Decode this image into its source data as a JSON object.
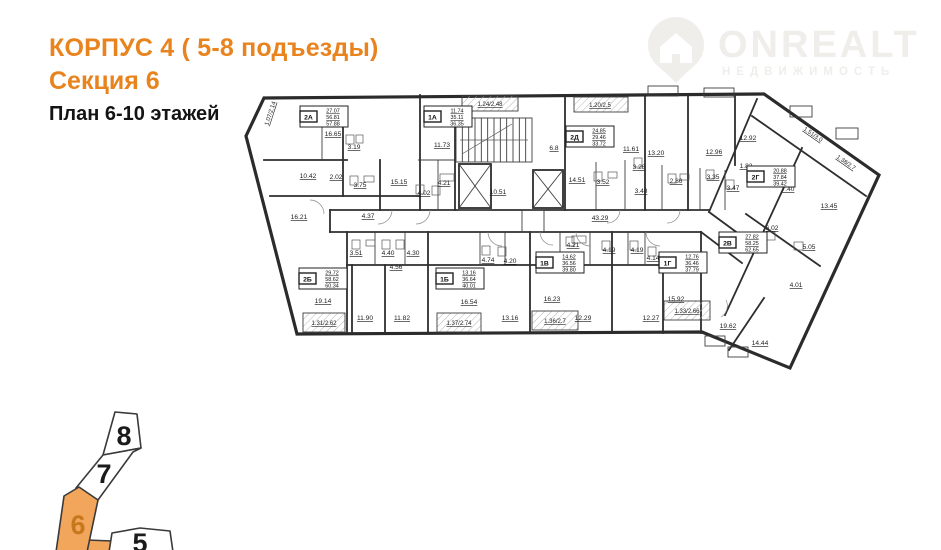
{
  "header": {
    "building": "КОРПУС 4 ( 5-8 подъезды)",
    "section": "Секция 6",
    "floors": "План 6-10 этажей"
  },
  "watermark": {
    "brand": "ONREALT",
    "tagline": "НЕДВИЖИМОСТЬ"
  },
  "colors": {
    "accent": "#e8831d",
    "plan_line": "#2e2e2e",
    "minimap_fill": "#f2a65b",
    "minimap_number": "#c8781c",
    "watermark": "#f0eeea"
  },
  "floorplan": {
    "outline": [
      [
        264,
        98
      ],
      [
        764,
        94
      ],
      [
        879,
        175
      ],
      [
        790,
        368
      ],
      [
        702,
        332
      ],
      [
        297,
        334
      ],
      [
        246,
        136
      ]
    ],
    "walls": [
      [
        420,
        95,
        420,
        210
      ],
      [
        455,
        117,
        455,
        210
      ],
      [
        565,
        95,
        565,
        210
      ],
      [
        645,
        95,
        645,
        210
      ],
      [
        688,
        95,
        688,
        210
      ],
      [
        735,
        96,
        735,
        165
      ],
      [
        757,
        99,
        709,
        212
      ],
      [
        330,
        210,
        709,
        210
      ],
      [
        330,
        232,
        701,
        232
      ],
      [
        709,
        212,
        758,
        248
      ],
      [
        701,
        232,
        742,
        263
      ],
      [
        347,
        232,
        347,
        333
      ],
      [
        428,
        232,
        428,
        333
      ],
      [
        530,
        232,
        530,
        333
      ],
      [
        612,
        232,
        612,
        333
      ],
      [
        701,
        232,
        701,
        333
      ],
      [
        347,
        265,
        701,
        265
      ],
      [
        352,
        265,
        352,
        333
      ],
      [
        385,
        265,
        385,
        333
      ],
      [
        663,
        265,
        663,
        333
      ],
      [
        264,
        160,
        347,
        160
      ],
      [
        270,
        196,
        420,
        196
      ],
      [
        343,
        120,
        343,
        196
      ],
      [
        380,
        160,
        380,
        210
      ],
      [
        330,
        210,
        330,
        232
      ],
      [
        752,
        116,
        866,
        196
      ],
      [
        802,
        148,
        725,
        315
      ],
      [
        746,
        214,
        820,
        266
      ],
      [
        764,
        298,
        729,
        350
      ]
    ],
    "partitions": [
      [
        596,
        162,
        596,
        210
      ],
      [
        625,
        160,
        625,
        210
      ],
      [
        662,
        165,
        662,
        210
      ],
      [
        700,
        168,
        700,
        210
      ],
      [
        725,
        170,
        725,
        210
      ],
      [
        375,
        232,
        375,
        265
      ],
      [
        405,
        232,
        405,
        265
      ],
      [
        480,
        232,
        480,
        265
      ],
      [
        505,
        232,
        505,
        265
      ],
      [
        560,
        232,
        560,
        265
      ],
      [
        590,
        232,
        590,
        265
      ],
      [
        628,
        232,
        628,
        265
      ],
      [
        645,
        232,
        645,
        265
      ],
      [
        322,
        120,
        322,
        160
      ],
      [
        438,
        160,
        438,
        210
      ],
      [
        418,
        160,
        455,
        160
      ]
    ],
    "rects": [
      [
        648,
        86,
        30,
        10
      ],
      [
        704,
        88,
        30,
        9
      ],
      [
        790,
        106,
        22,
        11
      ],
      [
        836,
        128,
        22,
        11
      ],
      [
        705,
        336,
        20,
        10
      ],
      [
        728,
        347,
        20,
        10
      ],
      [
        459,
        196,
        32,
        14
      ],
      [
        522,
        210,
        22,
        22
      ]
    ],
    "balcony_rects": [
      [
        462,
        96,
        56,
        15
      ],
      [
        574,
        97,
        54,
        15
      ],
      [
        303,
        313,
        42,
        19
      ],
      [
        437,
        313,
        44,
        19
      ],
      [
        532,
        311,
        46,
        19
      ],
      [
        664,
        301,
        46,
        19
      ]
    ],
    "stairs": {
      "x": 456,
      "y": 118,
      "w": 76,
      "h": 44,
      "steps": 12
    },
    "elevators": [
      [
        459,
        164,
        32,
        44
      ],
      [
        533,
        170,
        30,
        38
      ]
    ],
    "fixtures": [
      [
        346,
        135,
        8,
        9
      ],
      [
        356,
        135,
        7,
        8
      ],
      [
        350,
        176,
        8,
        9
      ],
      [
        364,
        176,
        10,
        6
      ],
      [
        416,
        185,
        8,
        9
      ],
      [
        432,
        186,
        8,
        9
      ],
      [
        594,
        172,
        8,
        9
      ],
      [
        608,
        172,
        9,
        6
      ],
      [
        634,
        158,
        8,
        9
      ],
      [
        668,
        174,
        8,
        9
      ],
      [
        680,
        174,
        9,
        6
      ],
      [
        706,
        170,
        8,
        9
      ],
      [
        726,
        180,
        8,
        9
      ],
      [
        352,
        240,
        8,
        9
      ],
      [
        366,
        240,
        9,
        6
      ],
      [
        382,
        240,
        8,
        9
      ],
      [
        396,
        240,
        8,
        9
      ],
      [
        482,
        246,
        8,
        9
      ],
      [
        498,
        247,
        8,
        9
      ],
      [
        566,
        237,
        8,
        9
      ],
      [
        602,
        241,
        8,
        9
      ],
      [
        630,
        241,
        8,
        9
      ],
      [
        648,
        247,
        8,
        9
      ],
      [
        766,
        232,
        9,
        8
      ],
      [
        794,
        242,
        9,
        8
      ],
      [
        440,
        174,
        14,
        7
      ],
      [
        572,
        236,
        14,
        7
      ]
    ],
    "doors": [
      "M392,210 a14,14 0 0,1 -14,14",
      "M430,210 a14,14 0 0,1 -14,14",
      "M620,210 a13,13 0 0,1 -13,13",
      "M680,210 a13,13 0 0,1 -13,13",
      "M488,232 a14,14 0 0,0 14,14",
      "M576,232 a14,14 0 0,0 14,14",
      "M646,232 a14,14 0 0,0 14,14",
      "M540,232 a13,13 0 0,0 13,13",
      "M726,300 a13,13 0 0,1 -5,17",
      "M310,200 a14,14 0 0,1 14,14"
    ],
    "apartments": [
      {
        "code": "2А",
        "areas": [
          "27.07",
          "56.81",
          "57.88"
        ],
        "x": 300,
        "y": 106
      },
      {
        "code": "1А",
        "areas": [
          "11.74",
          "35.11",
          "36.35"
        ],
        "x": 424,
        "y": 106
      },
      {
        "code": "2Д",
        "areas": [
          "24.85",
          "29.46",
          "33.72"
        ],
        "x": 566,
        "y": 126
      },
      {
        "code": "2Г",
        "areas": [
          "20.88",
          "37.84",
          "39.42"
        ],
        "x": 747,
        "y": 166
      },
      {
        "code": "2Б",
        "areas": [
          "29.72",
          "58.62",
          "60.34"
        ],
        "x": 299,
        "y": 268
      },
      {
        "code": "1Б",
        "areas": [
          "13.16",
          "36.64",
          "40.01"
        ],
        "x": 436,
        "y": 268
      },
      {
        "code": "1В",
        "areas": [
          "14.62",
          "36.56",
          "39.80"
        ],
        "x": 536,
        "y": 252
      },
      {
        "code": "1Г",
        "areas": [
          "12.76",
          "36.46",
          "37.79"
        ],
        "x": 659,
        "y": 252
      },
      {
        "code": "2В",
        "areas": [
          "27.82",
          "58.25",
          "62.65"
        ],
        "x": 719,
        "y": 232
      }
    ],
    "rooms": [
      {
        "a": "16.65",
        "x": 333,
        "y": 136
      },
      {
        "a": "3.19",
        "x": 354,
        "y": 149
      },
      {
        "a": "10.42",
        "x": 308,
        "y": 178
      },
      {
        "a": "2.02",
        "x": 336,
        "y": 179
      },
      {
        "a": "3.75",
        "x": 360,
        "y": 187
      },
      {
        "a": "15.15",
        "x": 399,
        "y": 184
      },
      {
        "a": "4.02",
        "x": 424,
        "y": 195
      },
      {
        "a": "4.21",
        "x": 444,
        "y": 185
      },
      {
        "a": "16.21",
        "x": 299,
        "y": 219
      },
      {
        "a": "4.37",
        "x": 368,
        "y": 218
      },
      {
        "a": "11.73",
        "x": 442,
        "y": 147
      },
      {
        "a": "10.51",
        "x": 498,
        "y": 194
      },
      {
        "a": "6.8",
        "x": 554,
        "y": 150
      },
      {
        "a": "14.51",
        "x": 577,
        "y": 182
      },
      {
        "a": "3.52",
        "x": 603,
        "y": 184
      },
      {
        "a": "11.61",
        "x": 631,
        "y": 151
      },
      {
        "a": "3.28",
        "x": 639,
        "y": 169
      },
      {
        "a": "13.20",
        "x": 656,
        "y": 155
      },
      {
        "a": "2.86",
        "x": 676,
        "y": 183
      },
      {
        "a": "3.48",
        "x": 641,
        "y": 193
      },
      {
        "a": "3.35",
        "x": 713,
        "y": 179
      },
      {
        "a": "12.96",
        "x": 714,
        "y": 154
      },
      {
        "a": "3.47",
        "x": 733,
        "y": 190
      },
      {
        "a": "1.82",
        "x": 746,
        "y": 168
      },
      {
        "a": "12.92",
        "x": 748,
        "y": 140
      },
      {
        "a": "43.29",
        "x": 600,
        "y": 220
      },
      {
        "a": "7.40",
        "x": 788,
        "y": 191
      },
      {
        "a": "13.45",
        "x": 829,
        "y": 208
      },
      {
        "a": "6.02",
        "x": 772,
        "y": 230
      },
      {
        "a": "5.05",
        "x": 809,
        "y": 249
      },
      {
        "a": "4.01",
        "x": 796,
        "y": 287
      },
      {
        "a": "19.62",
        "x": 728,
        "y": 328
      },
      {
        "a": "14.44",
        "x": 760,
        "y": 345
      },
      {
        "a": "3.51",
        "x": 356,
        "y": 255
      },
      {
        "a": "4.40",
        "x": 388,
        "y": 255
      },
      {
        "a": "4.30",
        "x": 413,
        "y": 255
      },
      {
        "a": "4.56",
        "x": 396,
        "y": 269
      },
      {
        "a": "19.14",
        "x": 323,
        "y": 303
      },
      {
        "a": "11.90",
        "x": 365,
        "y": 320
      },
      {
        "a": "11.82",
        "x": 402,
        "y": 320
      },
      {
        "a": "4.74",
        "x": 488,
        "y": 262
      },
      {
        "a": "4.20",
        "x": 510,
        "y": 263
      },
      {
        "a": "16.54",
        "x": 469,
        "y": 304
      },
      {
        "a": "13.16",
        "x": 510,
        "y": 320
      },
      {
        "a": "4.21",
        "x": 573,
        "y": 247
      },
      {
        "a": "4.19",
        "x": 609,
        "y": 252
      },
      {
        "a": "4.19",
        "x": 637,
        "y": 252
      },
      {
        "a": "4.14",
        "x": 653,
        "y": 260
      },
      {
        "a": "16.23",
        "x": 552,
        "y": 301
      },
      {
        "a": "12.29",
        "x": 583,
        "y": 320
      },
      {
        "a": "12.27",
        "x": 651,
        "y": 320
      },
      {
        "a": "15.92",
        "x": 676,
        "y": 301
      }
    ],
    "balconies": [
      {
        "a": "1.07/2.14",
        "x": 272,
        "y": 114,
        "rot": -72
      },
      {
        "a": "1.24/2.48",
        "x": 490,
        "y": 106,
        "rot": 0
      },
      {
        "a": "1.20/2.5",
        "x": 600,
        "y": 107,
        "rot": 0
      },
      {
        "a": "1.51/3.0",
        "x": 812,
        "y": 136,
        "rot": 35
      },
      {
        "a": "1.38/2.7",
        "x": 845,
        "y": 164,
        "rot": 35
      },
      {
        "a": "1.31/2.62",
        "x": 324,
        "y": 325,
        "rot": 0
      },
      {
        "a": "1.37/2.74",
        "x": 459,
        "y": 325,
        "rot": 0
      },
      {
        "a": "1.36/2.7",
        "x": 555,
        "y": 323,
        "rot": 0
      },
      {
        "a": "1.33/2.66",
        "x": 687,
        "y": 313,
        "rot": 0
      }
    ]
  },
  "minimap": {
    "sections": [
      {
        "label": "8",
        "points": "115,412 137,414 141,448 103,455",
        "highlighted": false,
        "num_x": 124,
        "num_y": 445
      },
      {
        "label": "7",
        "points": "103,455 141,448 133,452 98,500 76,488",
        "highlighted": false,
        "num_x": 104,
        "num_y": 483
      },
      {
        "label": "6",
        "points": "79,487 98,500 87,552 56,552 64,496",
        "highlighted": true,
        "num_x": 78,
        "num_y": 534
      },
      {
        "label": "5",
        "points": "112,533 140,528 170,531 173,552 109,552",
        "highlighted": false,
        "num_x": 140,
        "num_y": 552
      }
    ],
    "connector_points": "87,540 112,541 111,552 85,552"
  }
}
